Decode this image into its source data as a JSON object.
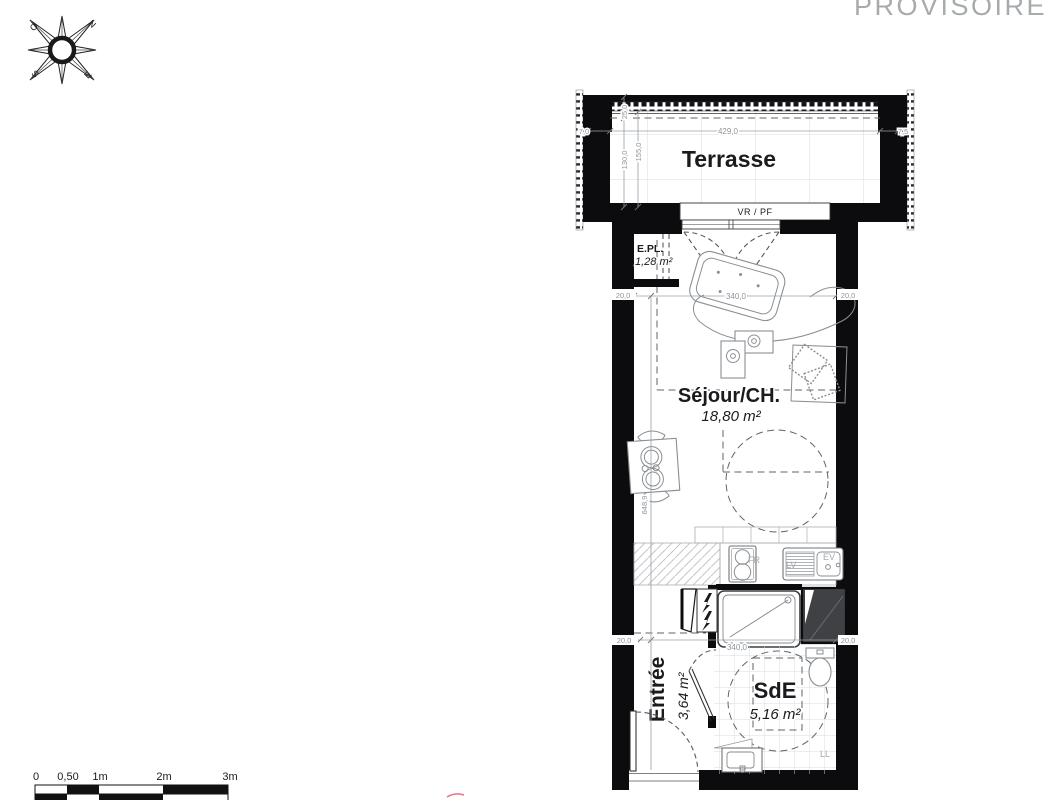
{
  "watermark": "PROVISOIRE",
  "compass": {
    "north": "N",
    "south": "S",
    "east": "E",
    "west": "O"
  },
  "terrace": {
    "label": "Terrasse",
    "window_label": "VR / PF"
  },
  "rooms": {
    "sejour": {
      "name": "Séjour/CH.",
      "area": "18,80 m²"
    },
    "epl": {
      "name": "E.PL.",
      "area": "1,28 m²"
    },
    "entree": {
      "name": "Entrée",
      "area": "3,64 m²"
    },
    "sde": {
      "name": "SdE",
      "area": "5,16 m²"
    }
  },
  "fixtures": {
    "sink": "EV",
    "dishwasher": "LV",
    "washing_machine": "LL",
    "fridge": "FR"
  },
  "dims": {
    "terrace_width": "429,0",
    "terrace_side_left": "7,0",
    "terrace_side_right": "7,5",
    "railing_depth": "25,0",
    "terrace_depth_inner": "130,0",
    "terrace_depth_total": "155,0",
    "room_width_top": "340,0",
    "room_width_bottom": "340,0",
    "room_depth": "648,9",
    "wall_top_left": "20,0",
    "wall_top_right": "20,0",
    "wall_bottom_left": "20,0",
    "wall_bottom_right": "20,0"
  },
  "scale_bar": {
    "ticks": [
      "0",
      "0,50",
      "1m",
      "2m",
      "3m"
    ]
  },
  "colors": {
    "wall": "#0c0c0e",
    "dim_text": "#8f959b",
    "watermark": "#a8abae",
    "red_mark": "#ec7186"
  }
}
